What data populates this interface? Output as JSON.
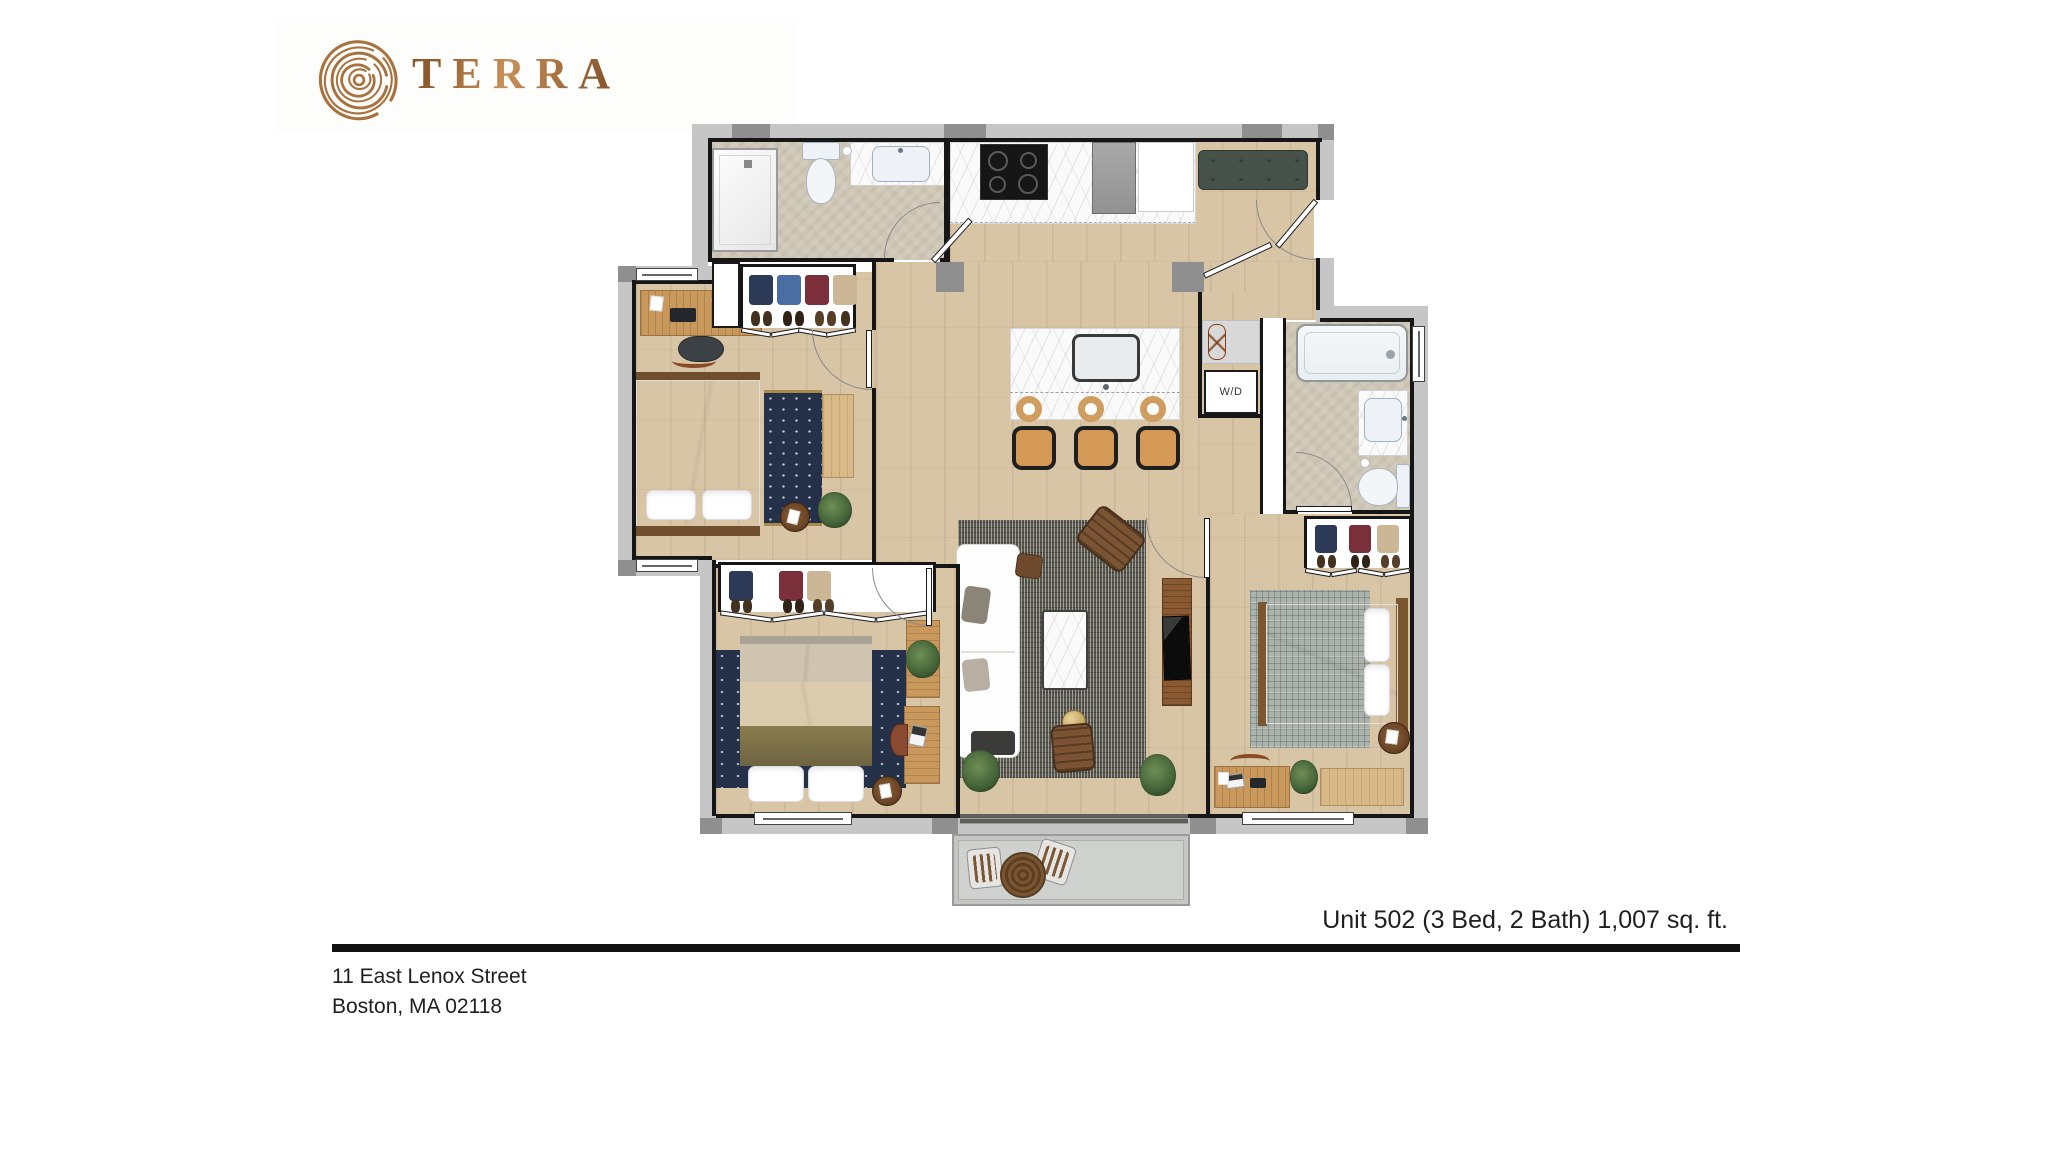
{
  "logo": {
    "brand": "TERRA",
    "color": "#b0793f"
  },
  "floor_plan": {
    "wd_label": "W/D",
    "colors": {
      "wood_floor": "#d8c5a6",
      "stone_floor": "#cfc7b5",
      "exterior_wall": "#c6c6c6",
      "wall_pier": "#8f8f8f",
      "interior_wall": "#161616",
      "bench_green": "#46514a",
      "navy_rug": "#253049",
      "living_rug": "#57564e",
      "plaid_rug": "#aab2ab",
      "accent_orange": "#e0721f",
      "balcony_deck": "#cfd1ce"
    }
  },
  "caption": {
    "unit_info": "Unit 502 (3 Bed, 2 Bath) 1,007 sq. ft."
  },
  "address": {
    "line1": "11 East Lenox Street",
    "line2": "Boston, MA 02118"
  }
}
